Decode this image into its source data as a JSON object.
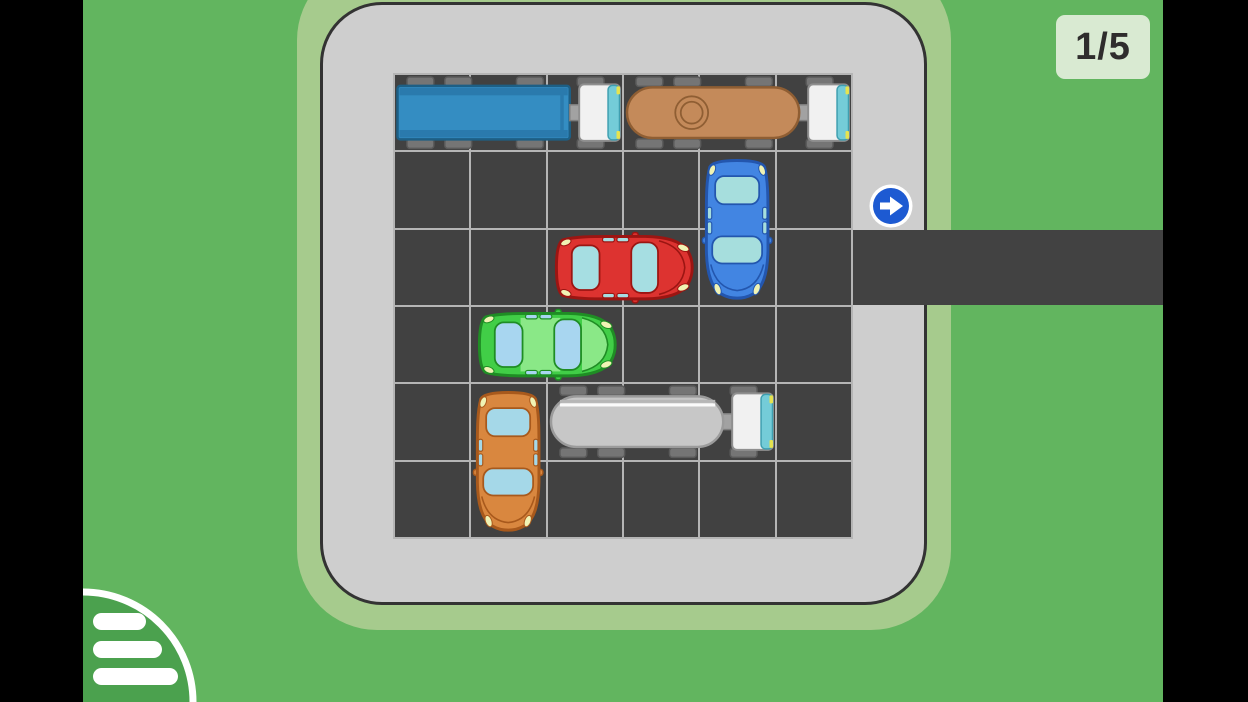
{
  "hud": {
    "level_label": "1/5"
  },
  "menu": {
    "icon": "hamburger-menu"
  },
  "exit": {
    "icon": "arrow-right",
    "side": "right",
    "row": 3,
    "sign_color": "#1d5ad2"
  },
  "board": {
    "rows": 6,
    "cols": 6
  },
  "vehicles": [
    {
      "name": "blue-box-truck",
      "type": "truck",
      "length": 3,
      "row": 1,
      "col": 1,
      "orientation": "horizontal",
      "facing": "right",
      "body": "#348dc2",
      "trim": "#2a7aad",
      "outline": "#1d5f85"
    },
    {
      "name": "brown-tanker-truck",
      "type": "tanker",
      "length": 3,
      "row": 1,
      "col": 4,
      "orientation": "horizontal",
      "facing": "right",
      "body": "#c48a5a",
      "outline": "#8f5e33",
      "variant": "manhole"
    },
    {
      "name": "blue-car",
      "type": "car",
      "length": 2,
      "row": 2,
      "col": 5,
      "orientation": "vertical",
      "facing": "down",
      "body": "#4285e2",
      "outline": "#2356ae",
      "window": "#a6dedd",
      "accent": "#4285e2"
    },
    {
      "name": "red-car",
      "type": "car",
      "length": 2,
      "row": 3,
      "col": 3,
      "orientation": "horizontal",
      "facing": "right",
      "body": "#dd3330",
      "outline": "#9c1512",
      "window": "#a6dee2",
      "accent": "#dd3330"
    },
    {
      "name": "green-car",
      "type": "car",
      "length": 2,
      "row": 4,
      "col": 2,
      "orientation": "horizontal",
      "facing": "right",
      "body": "#41ce47",
      "outline": "#1f8d24",
      "window": "#a8d6f0",
      "accent": "#8ae887"
    },
    {
      "name": "orange-car",
      "type": "car",
      "length": 2,
      "row": 5,
      "col": 2,
      "orientation": "vertical",
      "facing": "down",
      "body": "#d9873f",
      "outline": "#a8591c",
      "window": "#a5d8e8",
      "accent": "#d9873f"
    },
    {
      "name": "white-tanker-truck",
      "type": "tanker",
      "length": 3,
      "row": 5,
      "col": 3,
      "orientation": "horizontal",
      "facing": "right",
      "body": "#c7c7c7",
      "outline": "#9b9b9b",
      "variant": "stripe"
    }
  ],
  "colors": {
    "grass": "#62b55f",
    "halo": "#a6cb8d",
    "lot": "#cecece",
    "cell": "#414141",
    "gridline": "#b5b5b5",
    "road": "#424242",
    "sign_blue": "#1d5ad2",
    "badge_bg": "#d9ead2",
    "badge_text": "#2f2d2d",
    "menu_green": "#4ba14e",
    "cab_white": "#f1f1f1",
    "windshield_teal": "#74ccd8",
    "headlight_yellow": "#f0f3b4"
  }
}
